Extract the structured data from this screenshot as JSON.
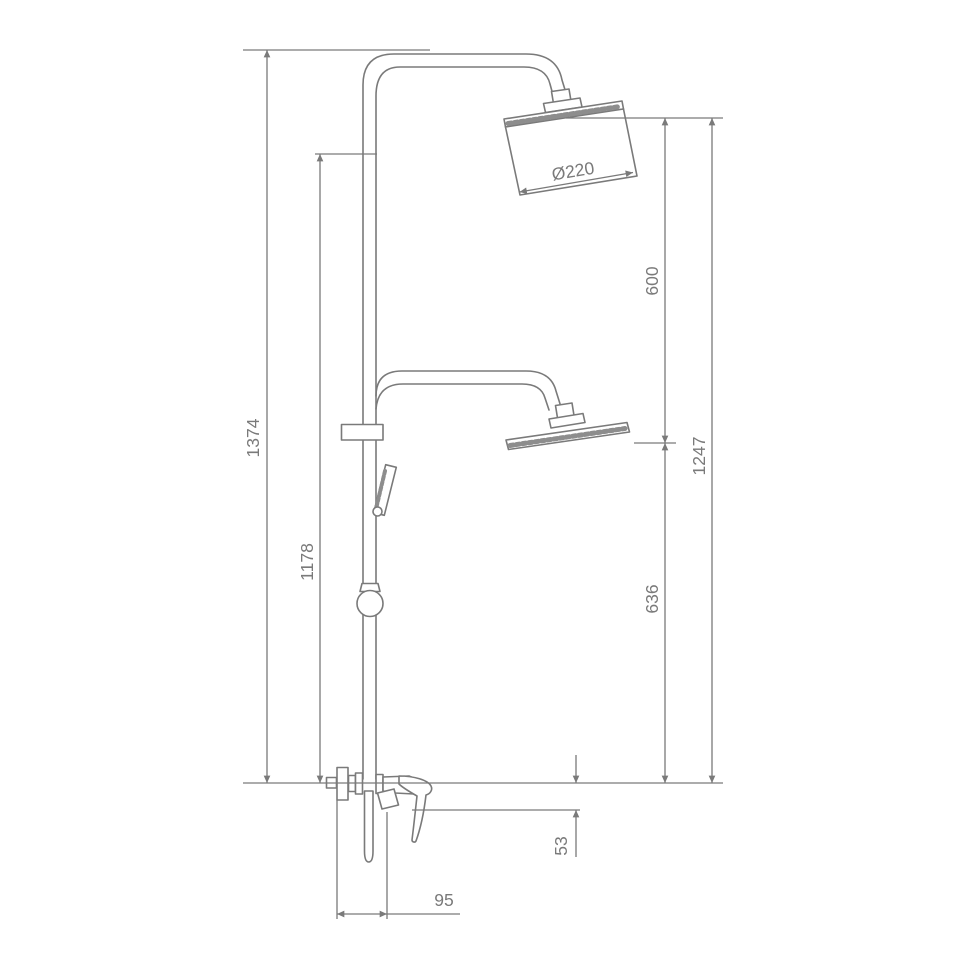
{
  "drawing": {
    "type": "technical-dimension-drawing",
    "subject": "shower column with dual overhead shower heads, hand shower and wall mixer valve",
    "units": "mm",
    "line_color": "#7a7a7a",
    "background": "#ffffff",
    "labels": {
      "total_height": "1374",
      "rail_height": "1178",
      "head_diameter": "Ø220",
      "upper_head_to_lower_head": "600",
      "lower_head_to_mixer": "636",
      "mixer_to_top_of_heads": "1247",
      "spout_drop": "53",
      "wall_to_spout": "95"
    }
  }
}
